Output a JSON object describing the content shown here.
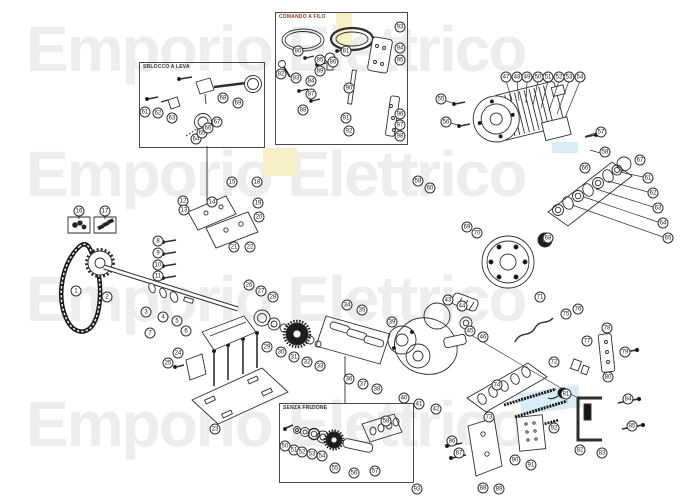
{
  "watermark": {
    "text": "Emporio Elettrico",
    "rows": 4,
    "color": "#ededed"
  },
  "highlights": {
    "yellow": "#f7efc5",
    "cyan": "#d8ecf6"
  },
  "insets": [
    {
      "id": "sblocco-a-leva",
      "label": "SBLOCCO A LEVA"
    },
    {
      "id": "comando-a-filo",
      "label": "COMANDO A FILO"
    },
    {
      "id": "senza-frizione",
      "label": "SENZA FRIZIONE"
    }
  ],
  "diagram": {
    "type": "exploded-parts-diagram",
    "subject": "gear motor drive assembly",
    "callouts": [
      [
        1,
        76,
        291
      ],
      [
        2,
        107,
        297
      ],
      [
        3,
        146,
        312
      ],
      [
        4,
        163,
        317
      ],
      [
        5,
        177,
        321
      ],
      [
        6,
        186,
        331
      ],
      [
        7,
        150,
        333
      ],
      [
        8,
        158,
        241
      ],
      [
        9,
        158,
        253
      ],
      [
        10,
        158,
        265
      ],
      [
        11,
        158,
        276
      ],
      [
        12,
        183,
        201
      ],
      [
        13,
        184,
        210
      ],
      [
        14,
        212,
        202
      ],
      [
        15,
        232,
        182
      ],
      [
        16,
        79,
        211
      ],
      [
        17,
        105,
        211
      ],
      [
        18,
        257,
        182
      ],
      [
        19,
        258,
        203
      ],
      [
        20,
        259,
        217
      ],
      [
        21,
        234,
        247
      ],
      [
        22,
        250,
        247
      ],
      [
        23,
        215,
        429
      ],
      [
        24,
        178,
        353
      ],
      [
        25,
        168,
        363
      ],
      [
        26,
        249,
        285
      ],
      [
        27,
        261,
        291
      ],
      [
        28,
        273,
        297
      ],
      [
        29,
        267,
        347
      ],
      [
        30,
        281,
        352
      ],
      [
        31,
        294,
        357
      ],
      [
        32,
        307,
        362
      ],
      [
        33,
        320,
        366
      ],
      [
        34,
        347,
        305
      ],
      [
        35,
        362,
        310
      ],
      [
        36,
        349,
        379
      ],
      [
        37,
        363,
        384
      ],
      [
        38,
        377,
        389
      ],
      [
        39,
        392,
        322
      ],
      [
        40,
        404,
        398
      ],
      [
        41,
        419,
        404
      ],
      [
        42,
        436,
        409
      ],
      [
        43,
        448,
        300
      ],
      [
        44,
        462,
        306
      ],
      [
        45,
        470,
        331
      ],
      [
        46,
        483,
        337
      ],
      [
        47,
        506,
        77
      ],
      [
        48,
        517,
        77
      ],
      [
        49,
        527,
        77
      ],
      [
        50,
        538,
        77
      ],
      [
        51,
        548,
        77
      ],
      [
        52,
        559,
        77
      ],
      [
        53,
        569,
        77
      ],
      [
        54,
        580,
        77
      ],
      [
        55,
        441,
        99
      ],
      [
        56,
        446,
        122
      ],
      [
        57,
        601,
        132
      ],
      [
        58,
        605,
        152
      ],
      [
        59,
        418,
        181
      ],
      [
        60,
        430,
        188
      ],
      [
        61,
        648,
        178
      ],
      [
        62,
        653,
        193
      ],
      [
        63,
        658,
        208
      ],
      [
        64,
        663,
        223
      ],
      [
        65,
        668,
        238
      ],
      [
        66,
        585,
        168
      ],
      [
        67,
        640,
        160
      ],
      [
        68,
        548,
        238
      ],
      [
        69,
        467,
        227
      ],
      [
        70,
        477,
        233
      ],
      [
        71,
        540,
        297
      ],
      [
        72,
        554,
        362
      ],
      [
        73,
        489,
        417
      ],
      [
        74,
        497,
        385
      ],
      [
        75,
        566,
        314
      ],
      [
        76,
        578,
        309
      ],
      [
        77,
        587,
        341
      ],
      [
        78,
        607,
        328
      ],
      [
        79,
        625,
        352
      ],
      [
        80,
        608,
        377
      ],
      [
        81,
        566,
        394
      ],
      [
        82,
        580,
        450
      ],
      [
        83,
        602,
        453
      ],
      [
        84,
        628,
        399
      ],
      [
        85,
        632,
        426
      ],
      [
        86,
        452,
        441
      ],
      [
        87,
        459,
        453
      ],
      [
        88,
        483,
        488
      ],
      [
        89,
        499,
        489
      ],
      [
        90,
        515,
        460
      ],
      [
        91,
        531,
        465
      ],
      [
        92,
        554,
        428
      ],
      [
        93,
        417,
        489
      ],
      [
        61,
        145,
        112
      ],
      [
        62,
        158,
        113
      ],
      [
        63,
        172,
        118
      ],
      [
        64,
        196,
        139
      ],
      [
        65,
        202,
        133
      ],
      [
        66,
        208,
        128
      ],
      [
        67,
        217,
        122
      ],
      [
        68,
        223,
        98
      ],
      [
        69,
        238,
        103
      ],
      [
        80,
        298,
        51
      ],
      [
        81,
        346,
        51
      ],
      [
        82,
        281,
        74
      ],
      [
        83,
        296,
        78
      ],
      [
        84,
        311,
        81
      ],
      [
        85,
        320,
        60
      ],
      [
        86,
        333,
        62
      ],
      [
        87,
        311,
        94
      ],
      [
        88,
        303,
        110
      ],
      [
        89,
        320,
        71
      ],
      [
        90,
        349,
        88
      ],
      [
        91,
        346,
        118
      ],
      [
        92,
        349,
        131
      ],
      [
        93,
        400,
        27
      ],
      [
        94,
        400,
        48
      ],
      [
        95,
        400,
        60
      ],
      [
        96,
        400,
        114
      ],
      [
        97,
        400,
        125
      ],
      [
        98,
        400,
        136
      ],
      [
        50,
        285,
        446
      ],
      [
        51,
        294,
        450
      ],
      [
        52,
        302,
        452
      ],
      [
        53,
        312,
        454
      ],
      [
        54,
        322,
        456
      ],
      [
        55,
        335,
        468
      ],
      [
        56,
        354,
        473
      ],
      [
        57,
        375,
        471
      ],
      [
        58,
        386,
        421
      ]
    ]
  }
}
